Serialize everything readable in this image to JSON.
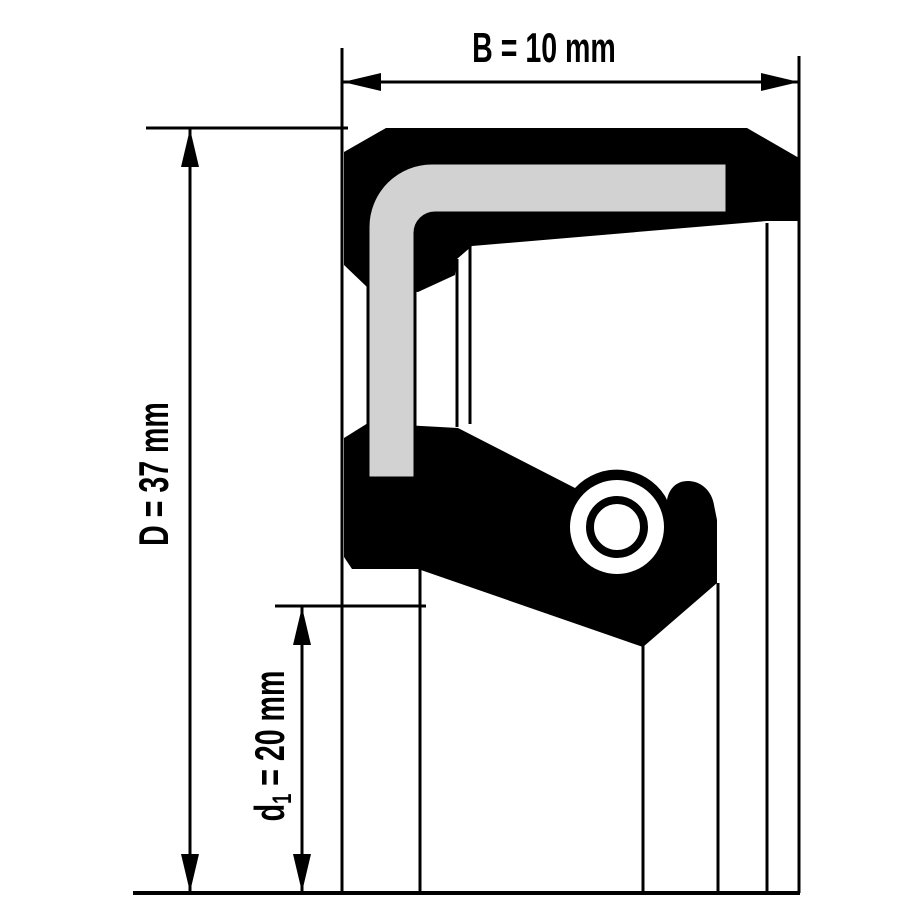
{
  "diagram": {
    "title": "seal cross-section dimension drawing",
    "labels": {
      "B": {
        "main": "B = 10 mm"
      },
      "D": {
        "main": "D = 37 mm"
      },
      "d1": {
        "prefix": "d",
        "sub": "1",
        "rest": " = 20 mm"
      }
    },
    "colors": {
      "line": "#000000",
      "rubber": "#000000",
      "metal_insert": "#d2d2d2",
      "background": "#ffffff"
    }
  }
}
